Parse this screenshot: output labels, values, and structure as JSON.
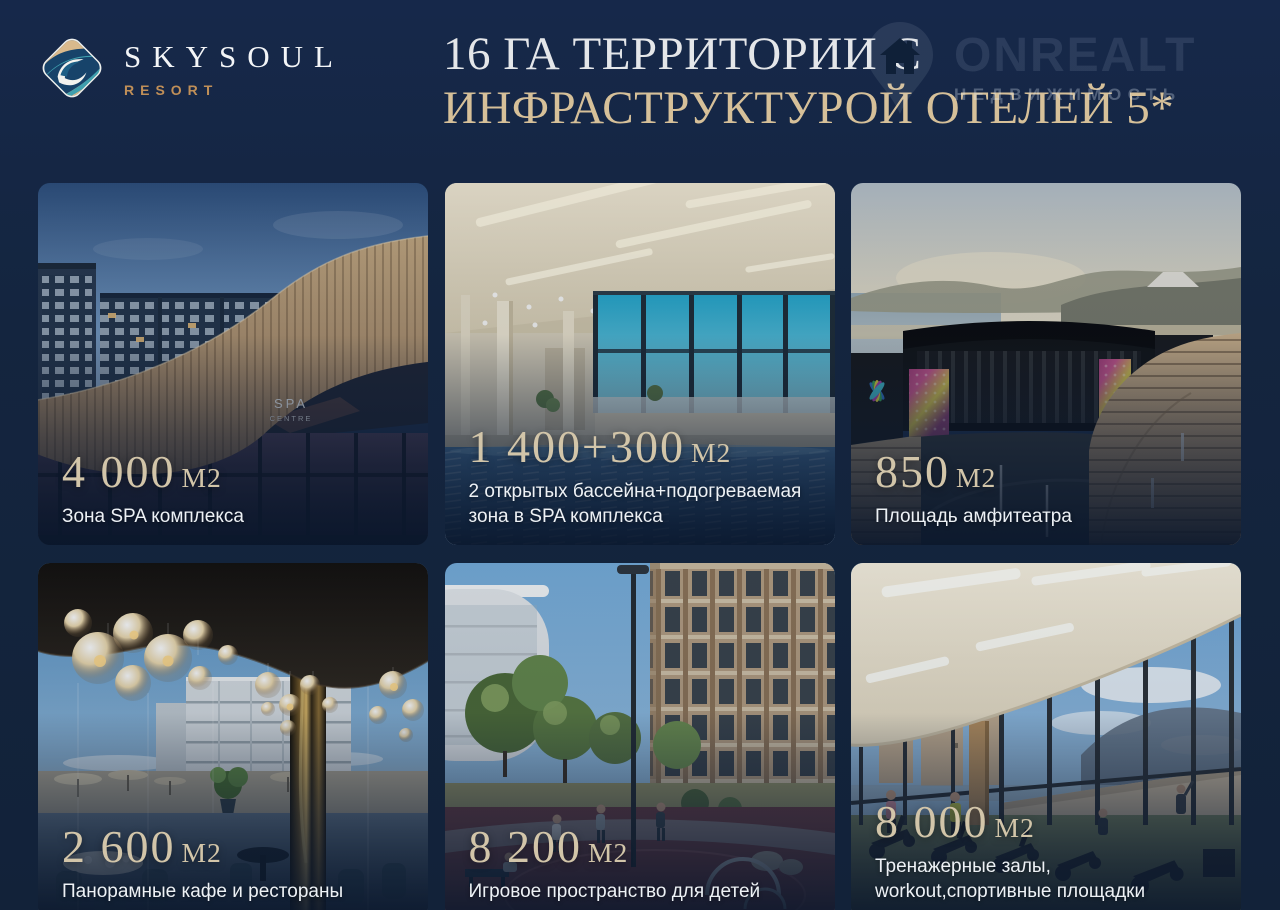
{
  "brand": {
    "name": "SKYSOUL",
    "subtitle": "RESORT"
  },
  "title": {
    "line1": "16 ГА ТЕРРИТОРИИ С",
    "line2": "ИНФРАСТРУКТУРОЙ ОТЕЛЕЙ 5*"
  },
  "watermark": {
    "name": "ONREALT",
    "tagline": "НЕДВИЖИМОСТЬ"
  },
  "photo_labels": {
    "spa_sign_top": "SPA",
    "spa_sign_bottom": "CENTRE"
  },
  "colors": {
    "background": "#14253F",
    "title_primary": "#E4E6E9",
    "title_secondary": "#D6C099",
    "number_text": "#D2C5A9",
    "caption_text": "#EDF1F5",
    "brand_accent": "#BF9360"
  },
  "cards": [
    {
      "id": "spa-complex",
      "area": "4 000",
      "unit": "М2",
      "caption": "Зона SPA комплекса"
    },
    {
      "id": "pools",
      "area": "1 400+300",
      "unit": "М2",
      "caption": "2 открытых бассейна+подогреваемая\nзона в SPA комплекса"
    },
    {
      "id": "amphitheater",
      "area": "850",
      "unit": "М2",
      "caption": "Площадь амфитеатра"
    },
    {
      "id": "cafes",
      "area": "2 600",
      "unit": "М2",
      "caption": "Панорамные кафе и рестораны"
    },
    {
      "id": "playground",
      "area": "8 200",
      "unit": "М2",
      "caption": "Игровое пространство для детей"
    },
    {
      "id": "gym",
      "area": "8 000",
      "unit": "М2",
      "caption": "Тренажерные залы,\nworkout,спортивные площадки"
    }
  ]
}
